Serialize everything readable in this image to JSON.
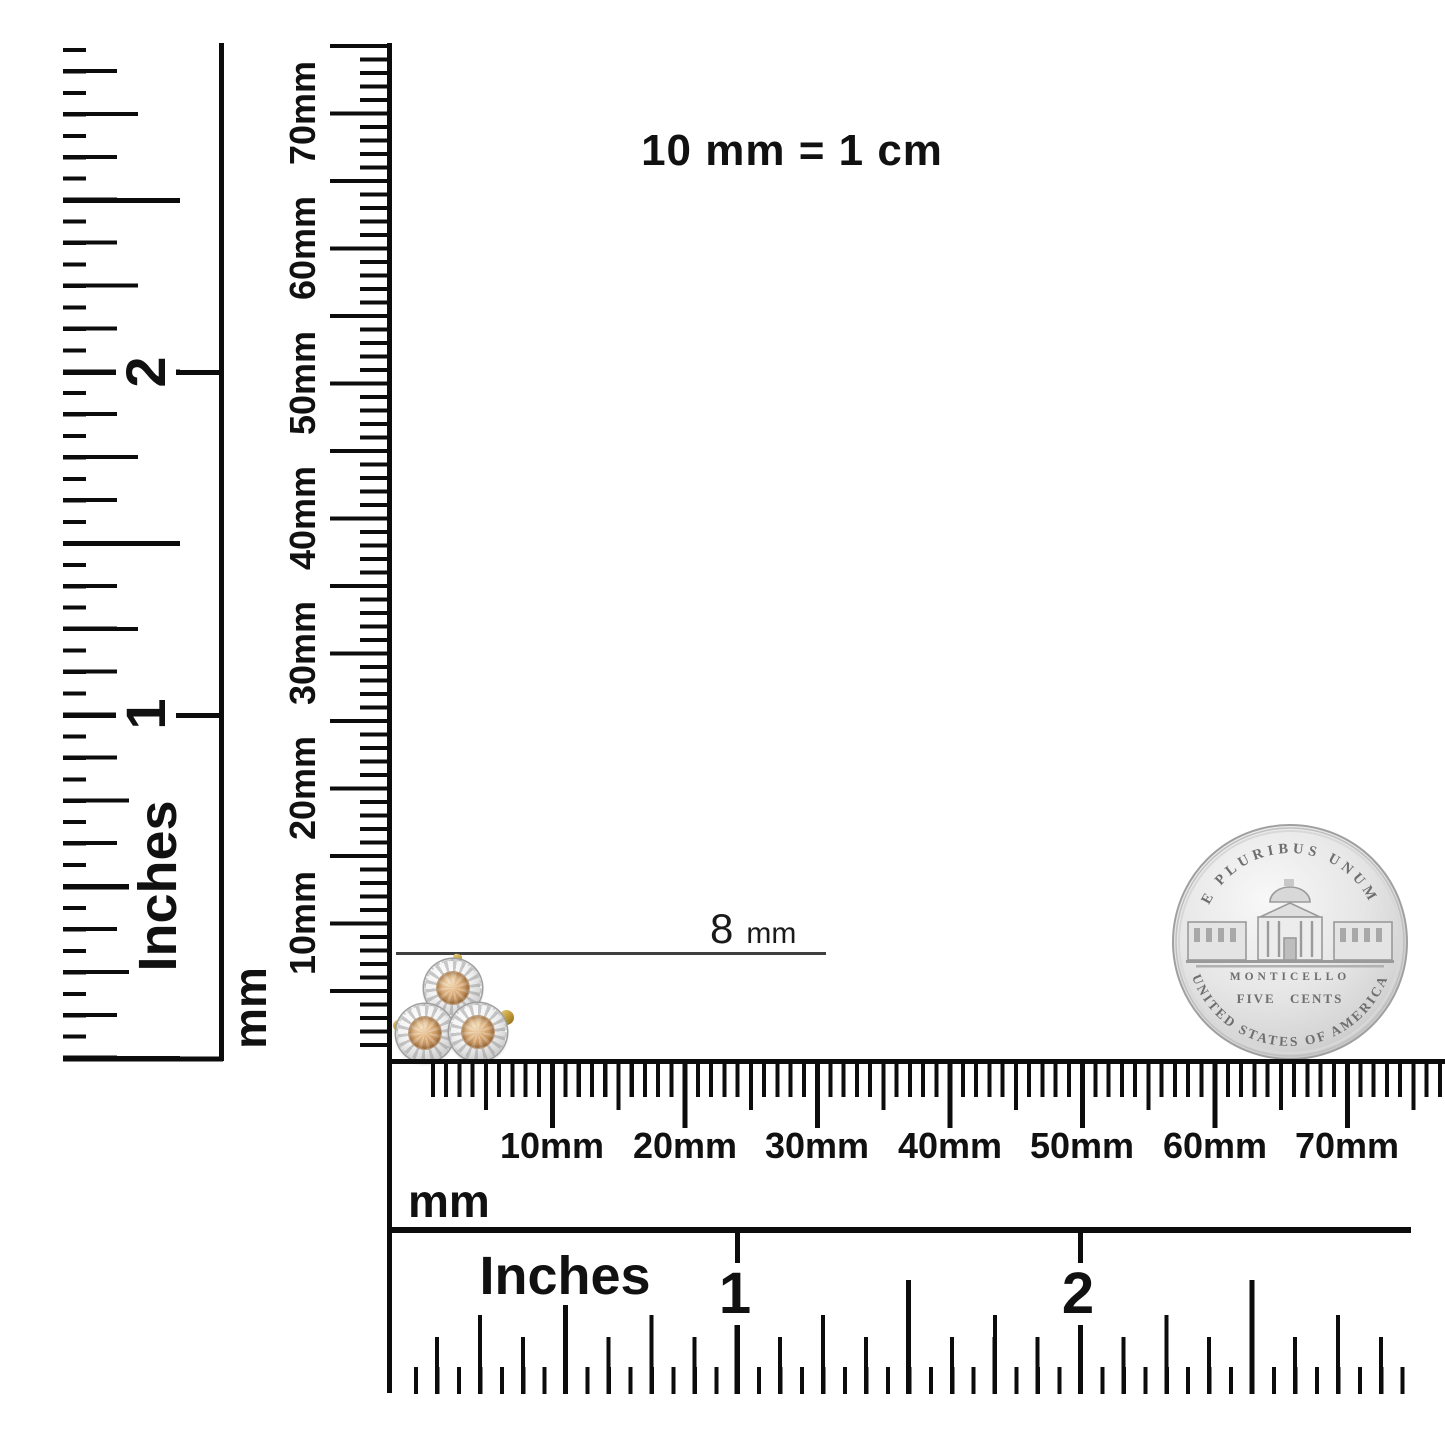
{
  "scale_note": "10 mm = 1 cm",
  "measurement": {
    "value": "8",
    "unit": "mm"
  },
  "rulers": {
    "vertical_inches": {
      "unit": "Inches",
      "numerals": [
        "1",
        "2"
      ]
    },
    "vertical_mm": {
      "unit": "mm",
      "labels": [
        "10mm",
        "20mm",
        "30mm",
        "40mm",
        "50mm",
        "60mm",
        "70mm"
      ]
    },
    "horizontal_mm": {
      "unit": "mm",
      "labels": [
        "10mm",
        "20mm",
        "30mm",
        "40mm",
        "50mm",
        "60mm",
        "70mm"
      ]
    },
    "horizontal_inches": {
      "unit": "Inches",
      "numerals": [
        "1",
        "2"
      ]
    }
  },
  "coin": {
    "motto": "E PLURIBUS UNUM",
    "building": "MONTICELLO",
    "denomination": "FIVE CENTS",
    "country": "UNITED STATES OF AMERICA"
  },
  "colors": {
    "ink": "#0c0c0c",
    "stone_champagne": "#c18d55",
    "setting_silver": "#e9e9e9",
    "gold_accent": "#b8922f",
    "coin_field": "#e3e3e3",
    "coin_text": "#6e6e6e"
  }
}
